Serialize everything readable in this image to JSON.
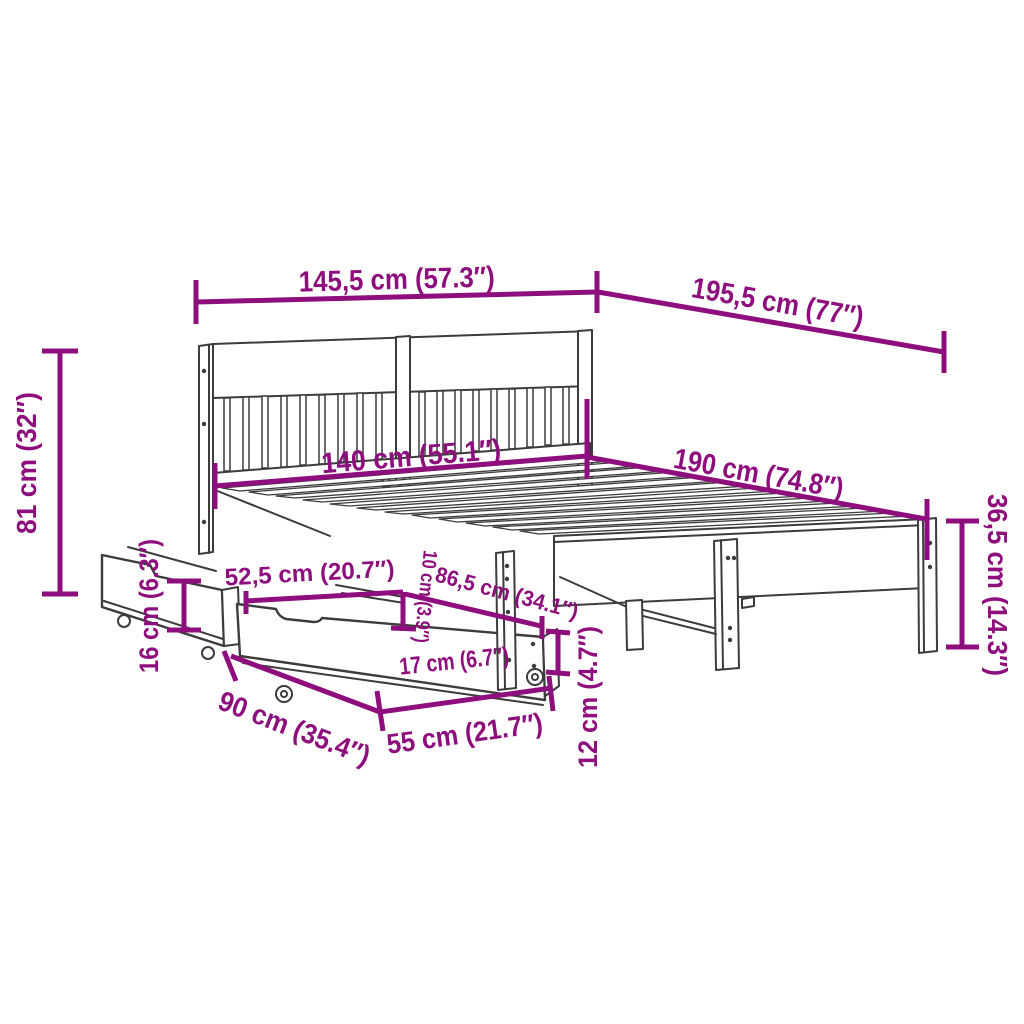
{
  "diagram": {
    "type": "furniture-dimension-diagram",
    "subject": "bed frame with headboard, slatted base and two storage drawers with casters",
    "colors": {
      "dimension": "#8E0E7D",
      "outline": "#3C3C3C",
      "background": "#FFFFFF"
    }
  },
  "labels": {
    "overall_width": "145,5 cm (57.3″)",
    "overall_length": "195,5 cm (77″)",
    "headboard_height": "81 cm (32″)",
    "slat_width": "140 cm (55.1″)",
    "slat_length": "190 cm (74.8″)",
    "frame_height": "36,5 cm (14.3″)",
    "drawer_side_height": "16 cm (6.3″)",
    "drawer_top_length": "52,5 cm (20.7″)",
    "rail_clearance": "10 cm (3.9″)",
    "drawer_diagonal": "86,5 cm (34.1″)",
    "drawer_front_height": "17 cm (6.7″)",
    "underbed_clearance": "12 cm (4.7″)",
    "drawer_depth": "90 cm (35.4″)",
    "drawer_length": "55 cm (21.7″)"
  }
}
